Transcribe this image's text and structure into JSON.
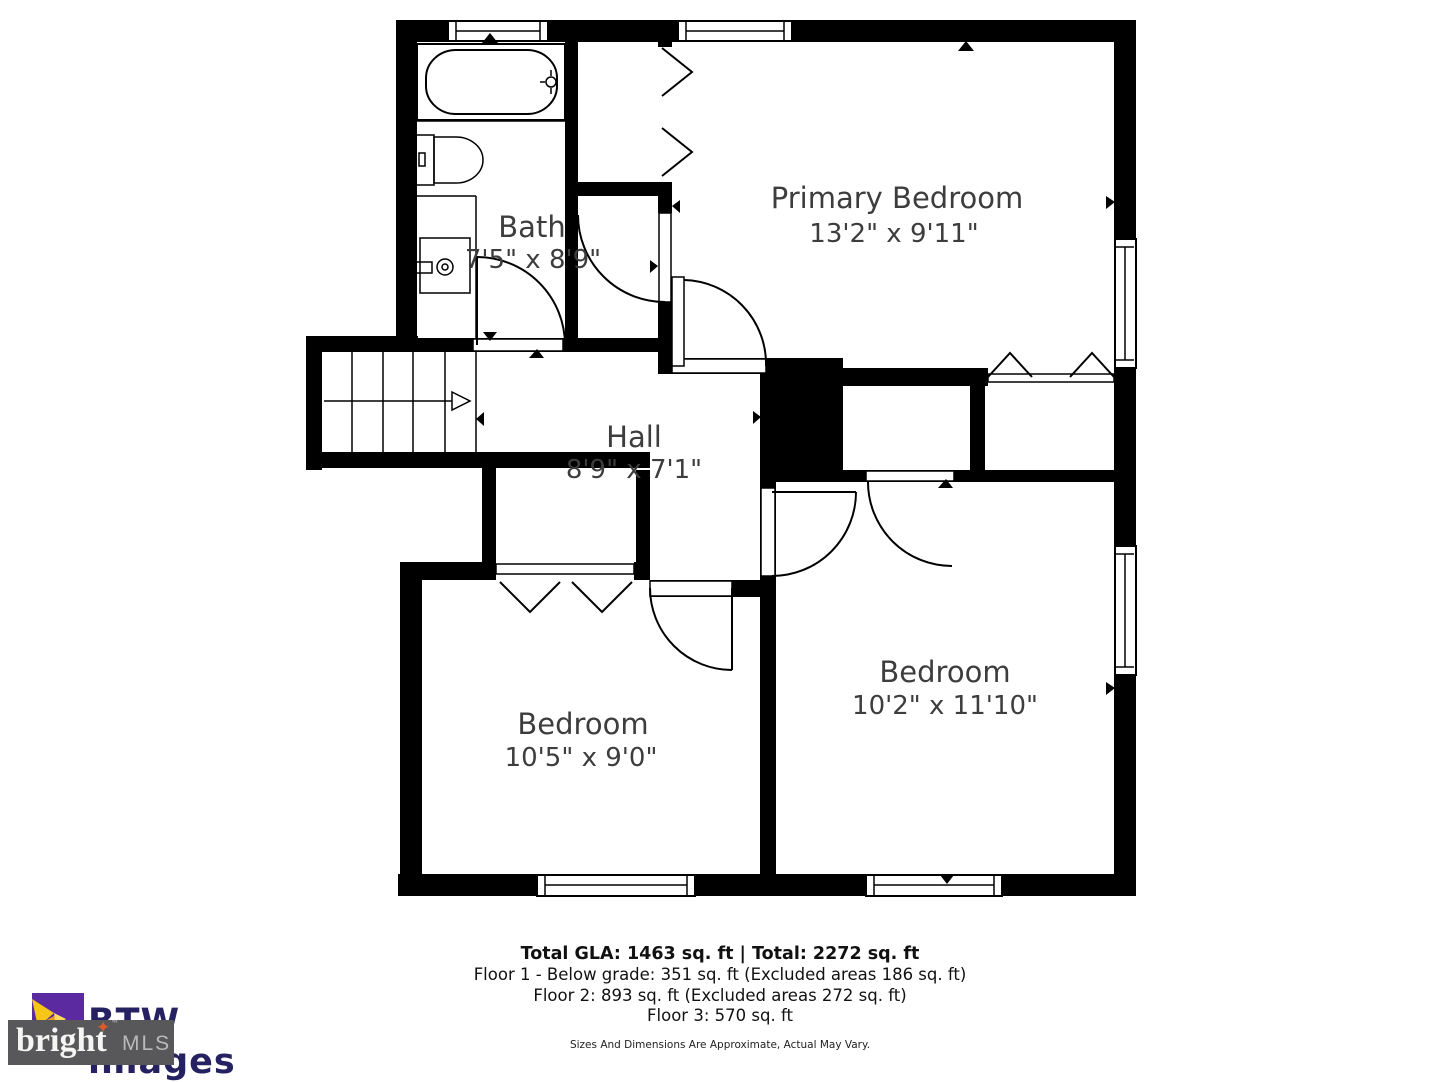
{
  "rooms": {
    "primary": {
      "name": "Primary Bedroom",
      "dims": "13'2\" x 9'11\""
    },
    "bath": {
      "name": "Bath",
      "dims": "7'5\" x 8'9\""
    },
    "hall": {
      "name": "Hall",
      "dims": "8'9\" x 7'1\""
    },
    "bedroom_left": {
      "name": "Bedroom",
      "dims": "10'5\" x 9'0\""
    },
    "bedroom_right": {
      "name": "Bedroom",
      "dims": "10'2\" x 11'10\""
    }
  },
  "summary": {
    "total_line": "Total GLA: 1463 sq. ft | Total: 2272 sq. ft",
    "floor1": "Floor 1 - Below grade: 351 sq. ft (Excluded areas 186 sq. ft)",
    "floor2": "Floor 2: 893 sq. ft (Excluded areas 272 sq. ft)",
    "floor3": "Floor 3: 570 sq. ft",
    "disclaimer": "Sizes And Dimensions Are Approximate, Actual May Vary."
  },
  "logos": {
    "btw": {
      "brand": "BTW images"
    },
    "bright": {
      "brand": "bright",
      "suffix": "MLS",
      "tm": "™",
      "star": "✦"
    }
  },
  "colors": {
    "walls": "#000000",
    "background": "#ffffff",
    "label_text": "#3d3d3d",
    "btw_purple": "#5b2aa0",
    "btw_gold": "#f0b429",
    "btw_navy": "#262262",
    "bright_box_gray": "#58585a",
    "bright_star_orange": "#e05a2b",
    "bright_mls_gray": "#b9b9bb"
  }
}
